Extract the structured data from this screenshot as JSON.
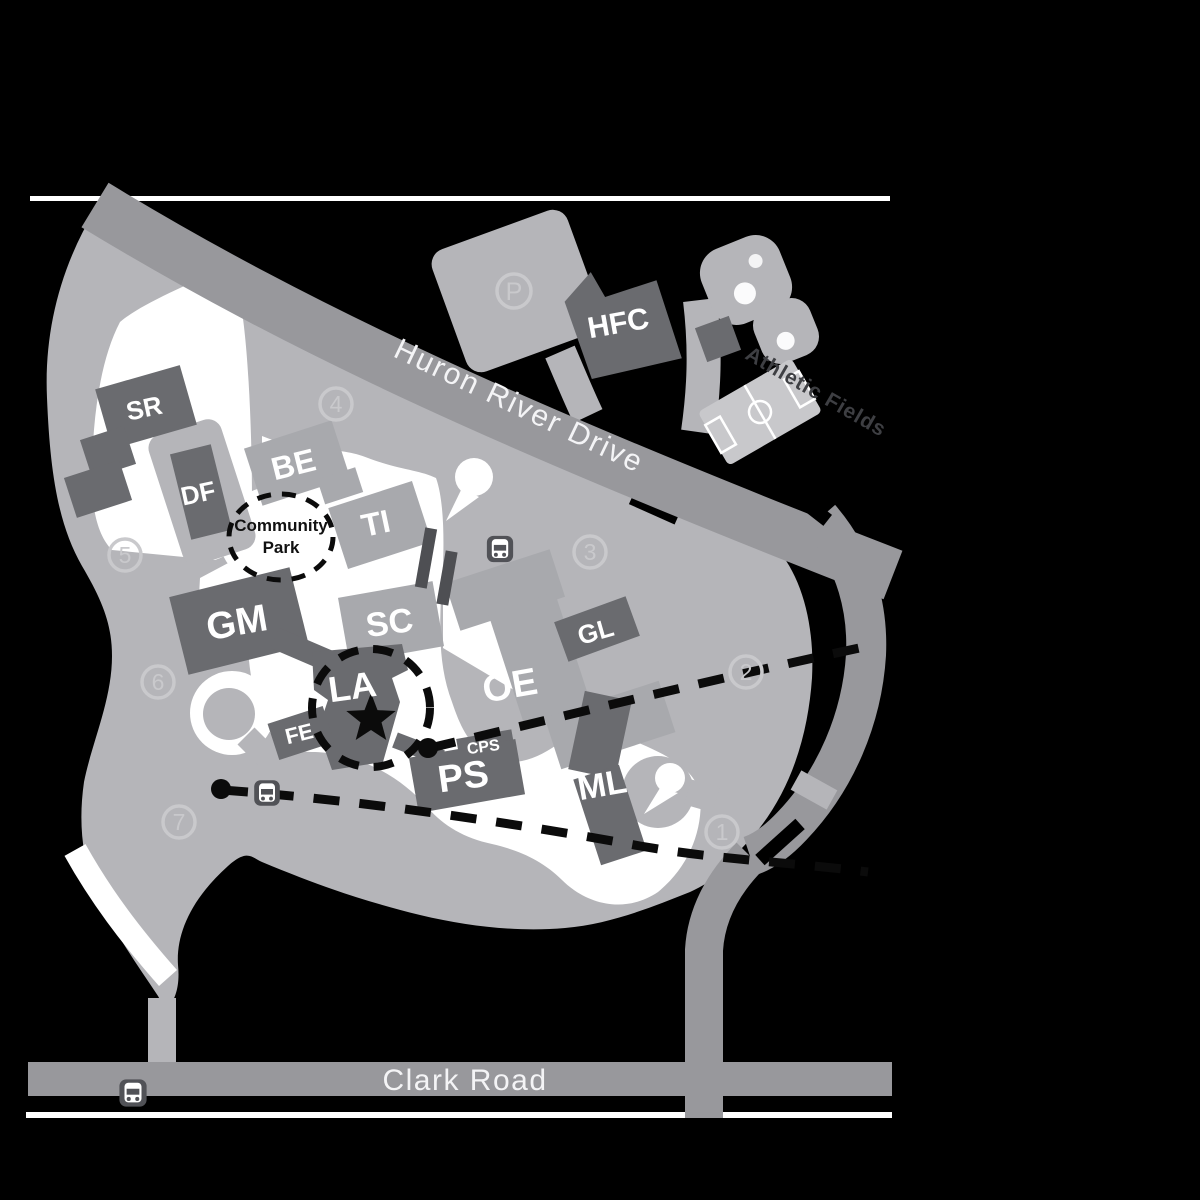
{
  "colors": {
    "background": "#000000",
    "road_light": "#b5b5b9",
    "road_mid": "#98989c",
    "building_dark": "#6a6b6f",
    "building_light": "#a8a9ad",
    "soccer_field": "#c8c8cb",
    "marker_light": "#c9c9cc",
    "route_dash": "#0b0b0b",
    "bus_icon_bg": "#515257"
  },
  "roads": {
    "huron": "Huron River Drive",
    "clark": "Clark Road"
  },
  "areas": {
    "community_park_line1": "Community",
    "community_park_line2": "Park",
    "athletic_fields": "Athletic Fields",
    "parking_label": "P"
  },
  "buildings": {
    "hfc": "HFC",
    "sr": "SR",
    "df": "DF",
    "be": "BE",
    "ti": "TI",
    "sc": "SC",
    "gm": "GM",
    "la": "LA",
    "fe": "FE",
    "ps": "PS",
    "cps": "CPS",
    "oe": "OE",
    "gl": "GL",
    "ml": "ML"
  },
  "stops": {
    "s1": "1",
    "s2": "2",
    "s3": "3",
    "s4": "4",
    "s5": "5",
    "s6": "6",
    "s7": "7"
  }
}
